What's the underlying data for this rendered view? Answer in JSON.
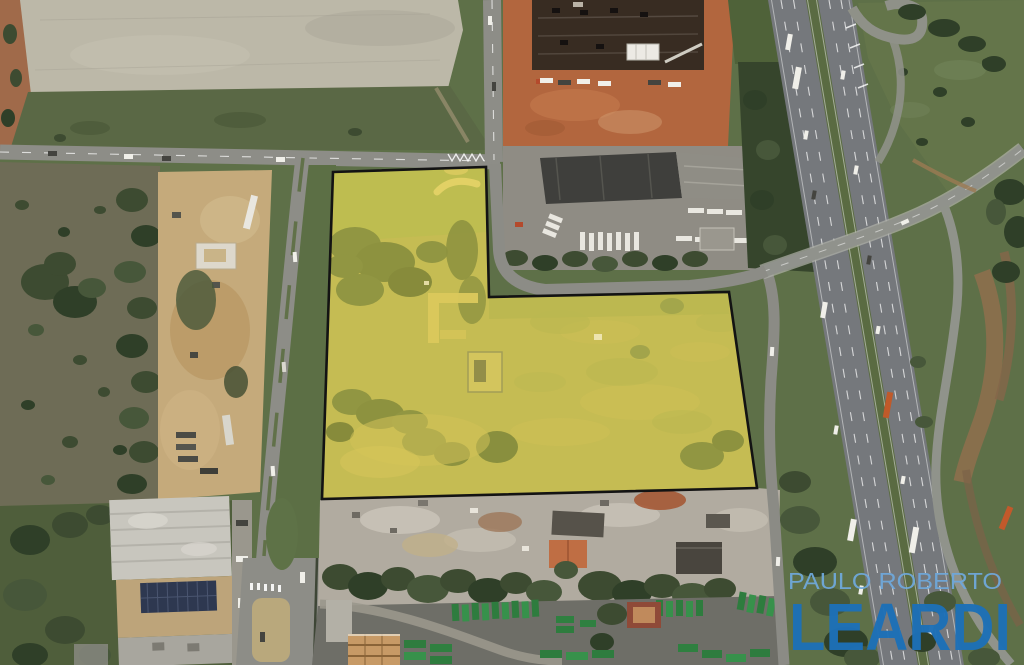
{
  "watermark": {
    "line1": "PAULO ROBERTO",
    "line2": "LEARDI"
  },
  "parcel": {
    "fill_opacity": "0.30"
  },
  "palette": {
    "parcel_yellow": "#e8d848",
    "parcel_outline": "#131313",
    "watermark_light_blue": "#6fa8da",
    "watermark_dark_blue": "#1d70b7",
    "vegetation_green": "#5e7048",
    "red_dirt": "#b2663e",
    "highway_gray": "#75787c",
    "container_green": "#2e7c3e",
    "parking_lot_gray": "#bcb8a8",
    "scrapyard_gray": "#b1aba0"
  }
}
